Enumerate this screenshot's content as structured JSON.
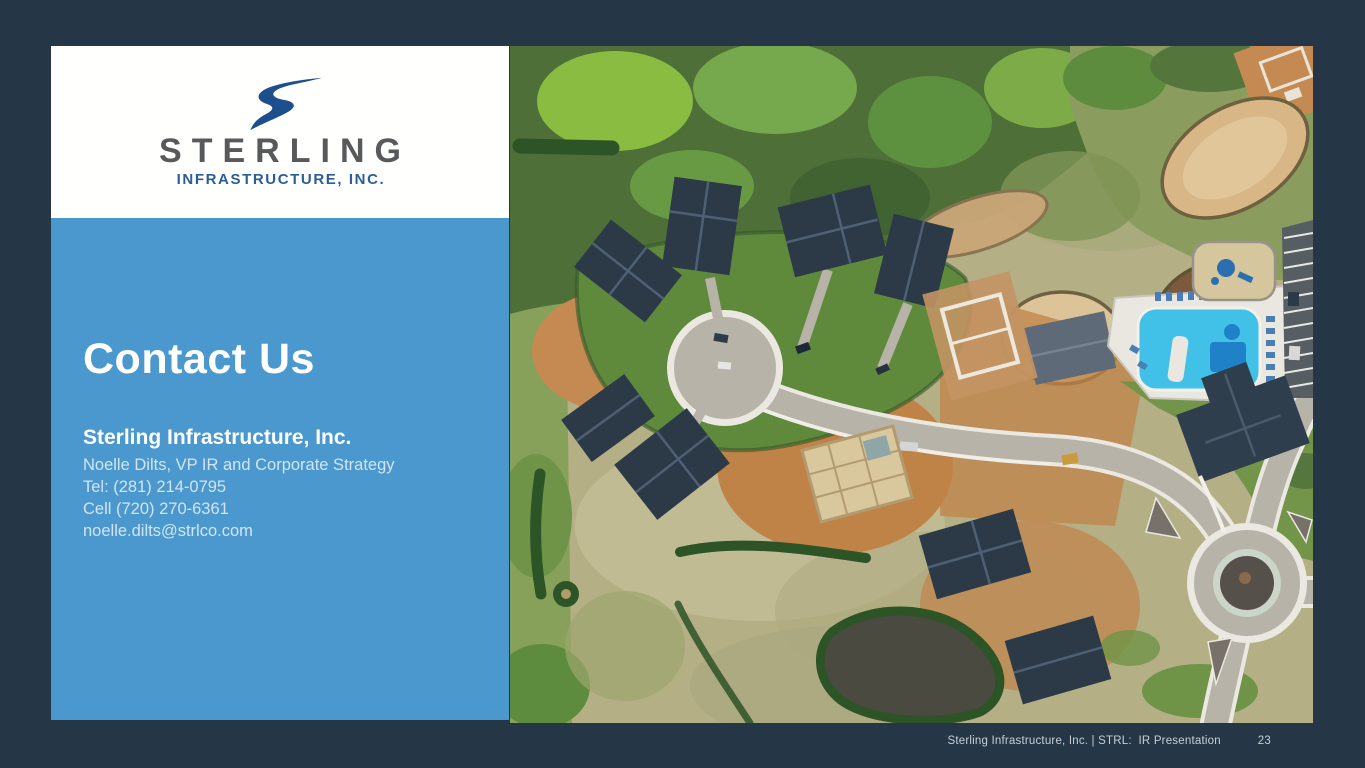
{
  "colors": {
    "background": "#253746",
    "panel_blue": "#4A98CE",
    "logo_swoosh": "#1D4F8E",
    "logo_name_gray": "#58595B",
    "logo_subtitle_blue": "#2B5D9B"
  },
  "logo": {
    "name": "STERLING",
    "subtitle": "INFRASTRUCTURE, INC."
  },
  "contact": {
    "heading": "Contact Us",
    "company": "Sterling Infrastructure, Inc.",
    "lines": [
      "Noelle Dilts, VP IR and Corporate Strategy",
      "Tel: (281) 214-0795",
      "Cell (720) 270-6361",
      "noelle.dilts@strlco.com"
    ]
  },
  "footer": {
    "text": "Sterling Infrastructure, Inc. | STRL:  IR Presentation",
    "page_number": "23"
  }
}
